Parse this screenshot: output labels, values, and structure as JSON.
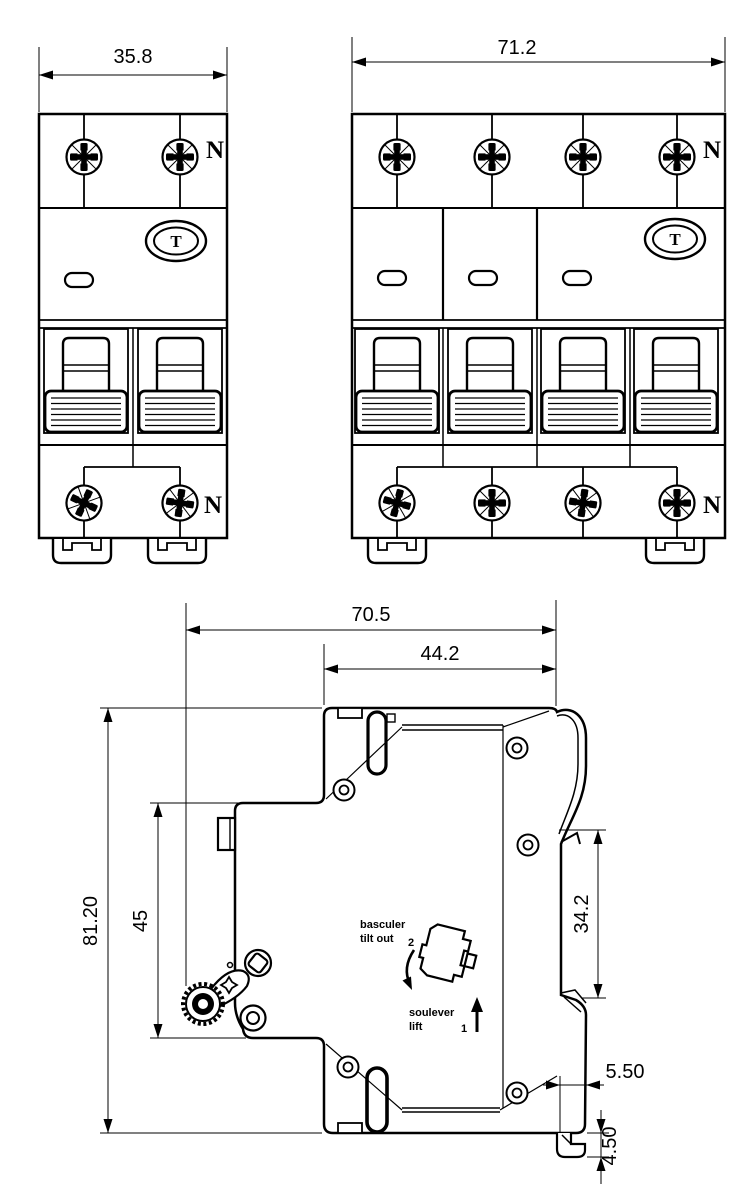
{
  "front_2pole": {
    "width_dim": "35.8",
    "neutral_top": "N",
    "neutral_bottom": "N",
    "test_button": "T"
  },
  "front_4pole": {
    "width_dim": "71.2",
    "neutral_top": "N",
    "neutral_bottom": "N",
    "test_button": "T"
  },
  "side_view": {
    "overall_depth_dim": "70.5",
    "upper_depth_dim": "44.2",
    "overall_height_dim": "81.20",
    "front_height_dim": "45",
    "rail_window_dim": "34.2",
    "rail_offset_dim": "5.50",
    "foot_height_dim": "4.50",
    "tilt_word_fr": "basculer",
    "tilt_word_en": "tilt out",
    "tilt_step": "2",
    "lift_word_fr": "soulever",
    "lift_word_en": "lift",
    "lift_step": "1"
  },
  "colors": {
    "line": "#000000",
    "bg": "#ffffff"
  }
}
